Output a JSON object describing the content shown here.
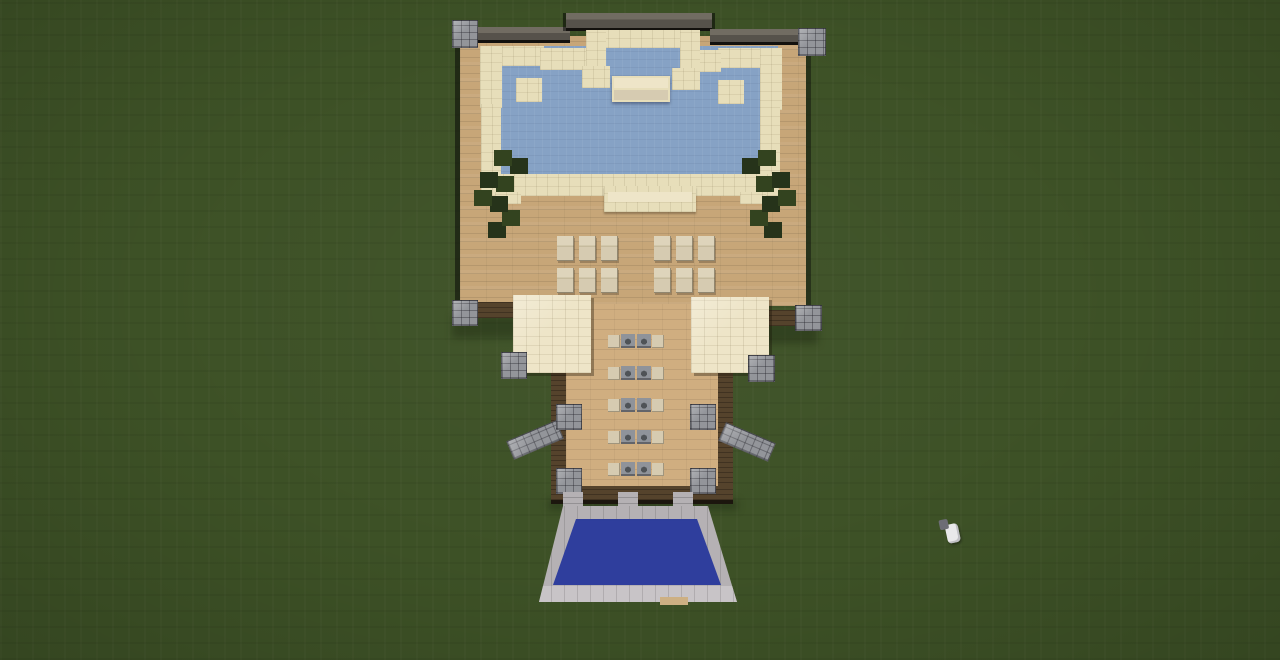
{
  "scene": {
    "game": "Minecraft",
    "view": "top-down aerial screenshot",
    "setting": "flat dark-green grass field",
    "description": "Overhead view of a sandstone-and-wood pool house: an indoor light-blue pool with corner hot tubs and a diving platform at the top, a wooden deck with lounge chairs, two sandstone canopies flanking a covered walkway with table rows and stone-brick buttresses, three stone paths leading to a royal-blue front pool with a smooth stone border, and a chicken wandering the grass to the right.",
    "objects": {
      "main_building": "pool house with wooden deck and dark roof edge wall",
      "upper_pool": "light blue water with sandstone border",
      "hot_tubs": 2,
      "diving_platform": 1,
      "trees": 2,
      "lounge_chairs": {
        "count": 12,
        "groups": 2,
        "per_group": 6,
        "rows_per_group": 2,
        "cols_per_group": 3
      },
      "canopies": 2,
      "walkway_tables": {
        "count": 5
      },
      "stone_buttresses": 2,
      "corner_pillars": "stone brick",
      "entry_paths": 3,
      "front_pool": "royal blue pool with smooth stone border",
      "chicken": 1
    }
  },
  "colors": {
    "grass": "#3d5126",
    "wood": "#c7a678",
    "wood-light": "#d0ae80",
    "sandstone": "#e7deba",
    "sandstone-light": "#eee5c8",
    "slab": "#d6cbb1",
    "water": "#86a2c5",
    "pool-blue": "#2f3e9d",
    "stone": "#93959a",
    "smoothstone": "#b5b1b4",
    "smoothstone-light": "#c8c4c7",
    "trim": "#55432c",
    "wall-dark": "#56524b",
    "wall-top": "#716c62",
    "leaf": "#33431f",
    "leaf-dark": "#26331a",
    "table-gray": "#8f939a",
    "sand-block": "#cdb083",
    "chicken-white": "#e9e9ea",
    "chicken-head": "#6d6d75"
  }
}
